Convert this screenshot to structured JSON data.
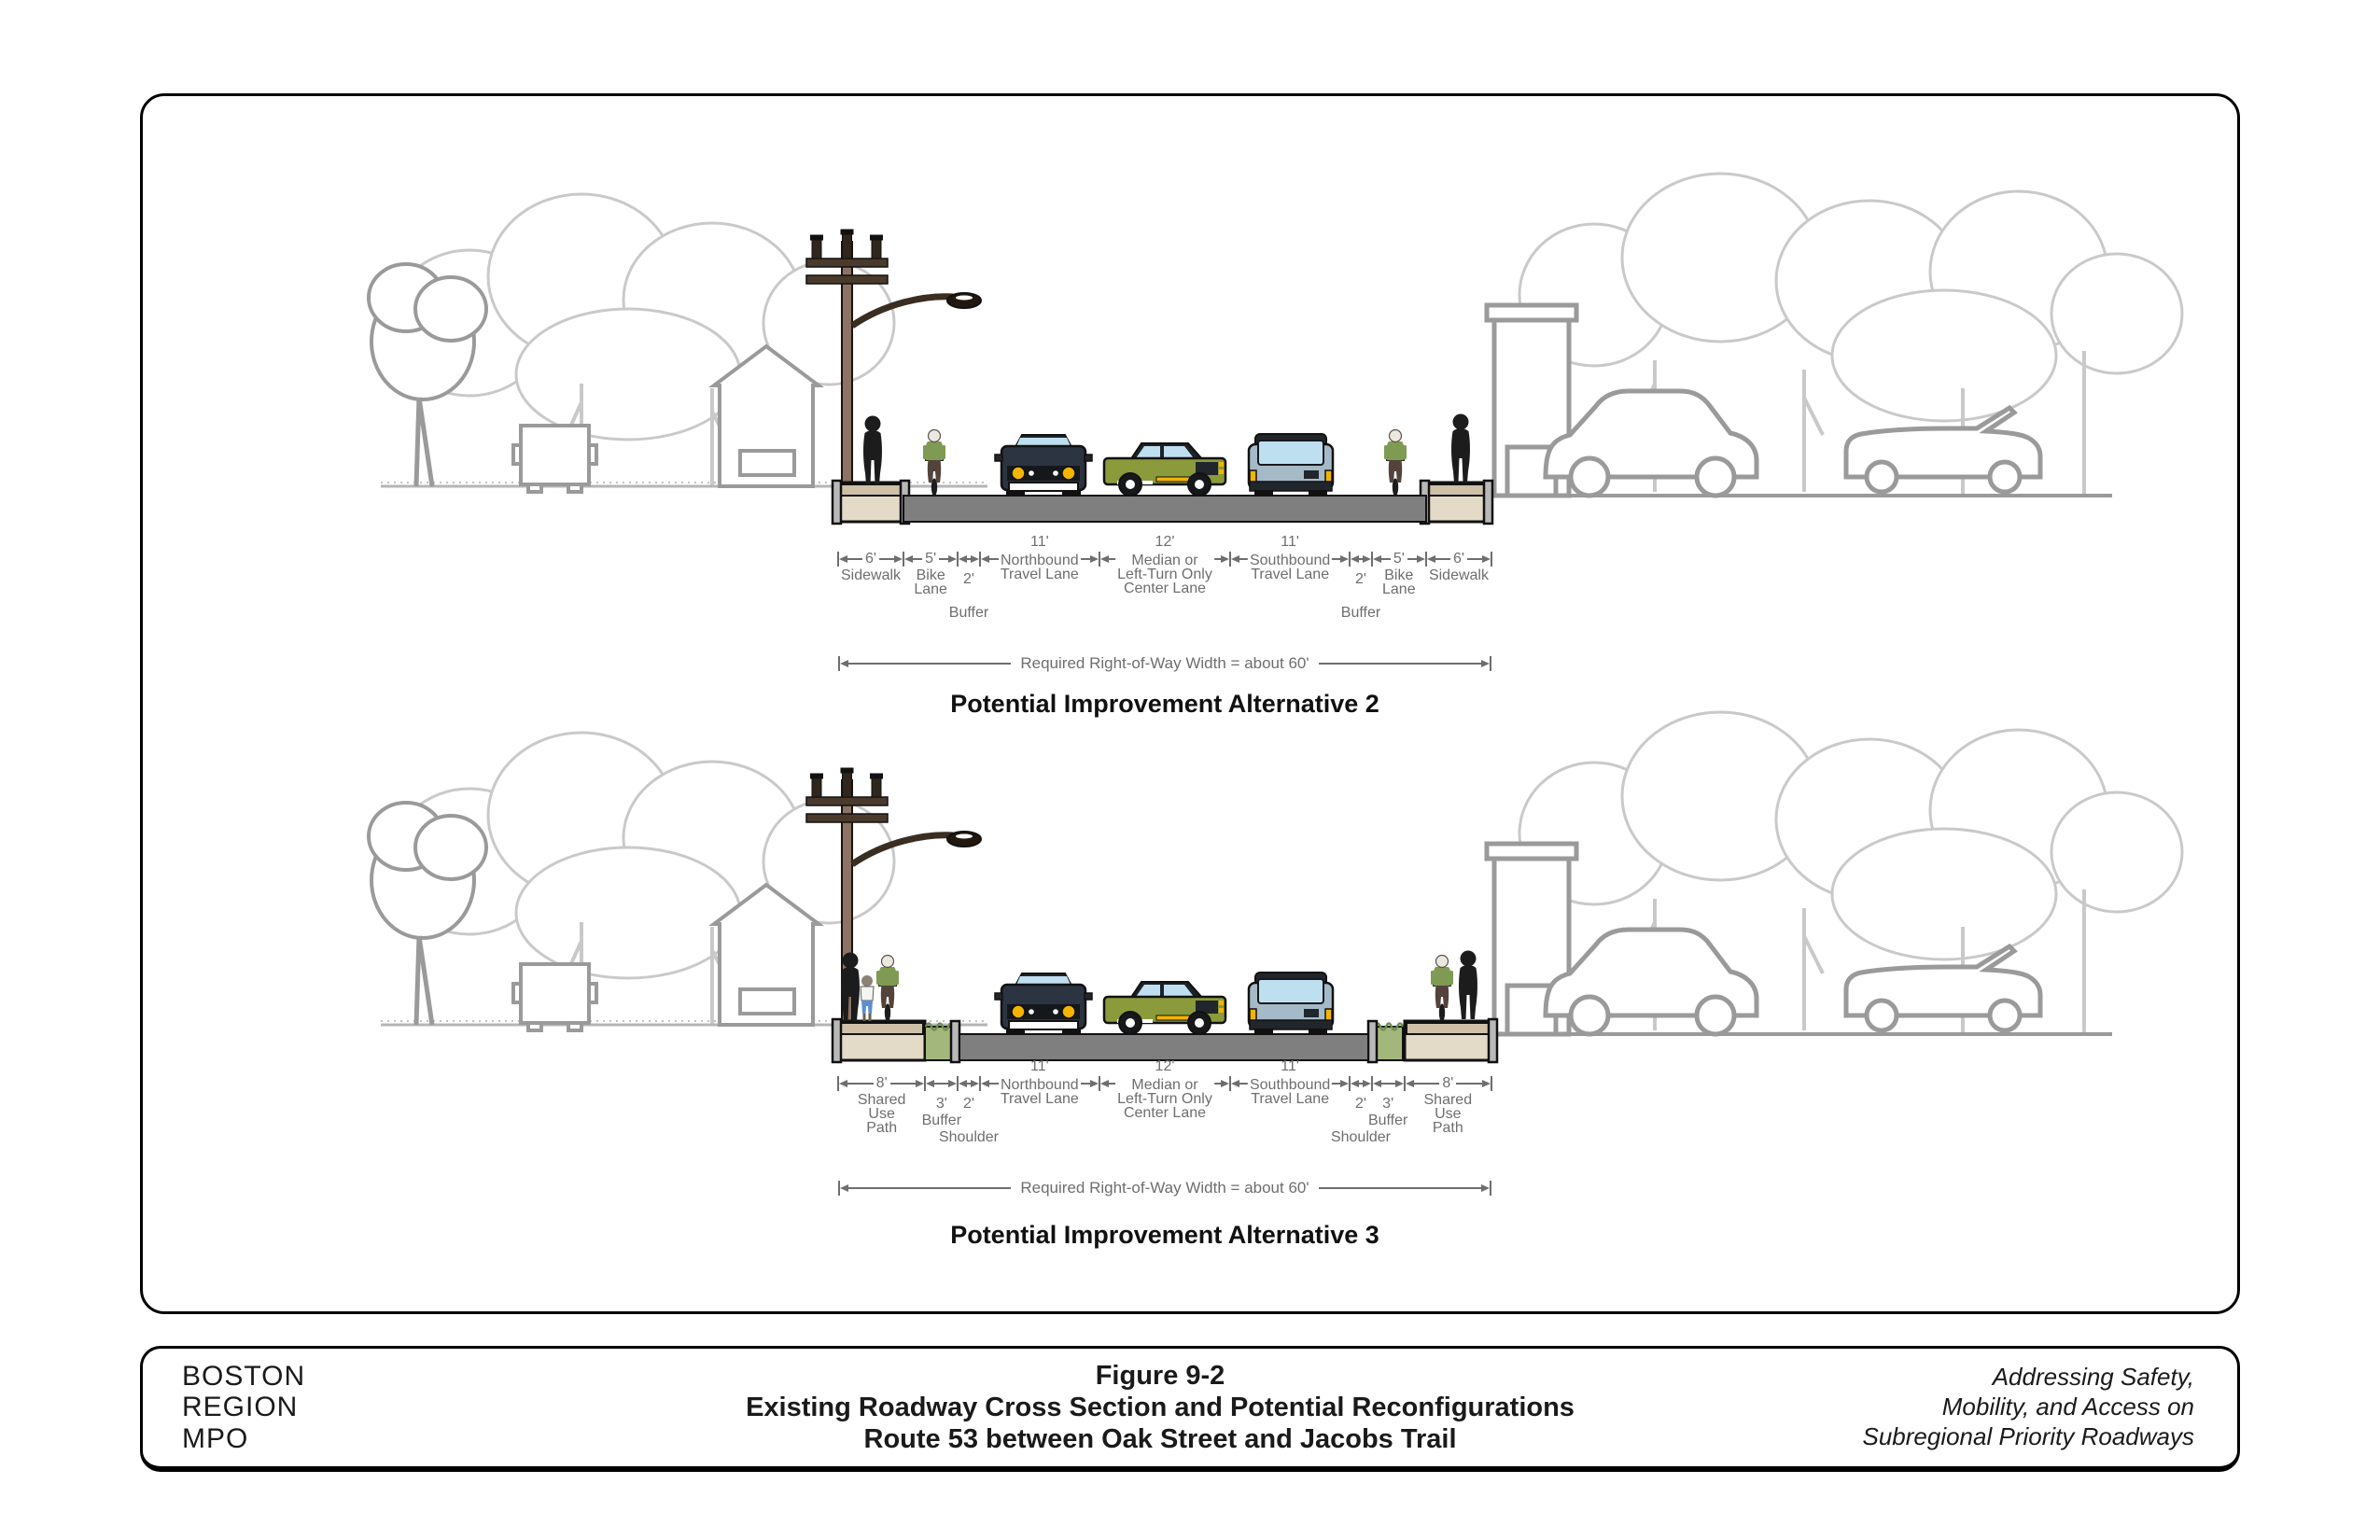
{
  "colors": {
    "road": "#7f7f7f",
    "sidewalk": "#cfc0a8",
    "sidewalk_light": "#e4dac8",
    "curb": "#b9b9b9",
    "grass_buffer": "#a3b77d",
    "grass_dark": "#6e8f50",
    "pole": "#8c7365",
    "tree_light": "#c9c9c9",
    "tree_dark": "#9a9a9a",
    "silhouette": "#1c1c1c",
    "shirt": "#7f9a52",
    "car_front_body": "#2b3440",
    "car_green": "#8b9a3b",
    "car_rear": "#a5bac8",
    "window": "#bedff0",
    "headlight": "#f4b400",
    "dim_text": "#6e6e6e"
  },
  "alt2": {
    "caption": "Potential Improvement Alternative 2",
    "row_label": "Required Right-of-Way Width = about 60'",
    "segments": [
      {
        "width_label": "6'",
        "name": "Sidewalk",
        "feet": 6
      },
      {
        "width_label": "5'",
        "name": "Bike\nLane",
        "feet": 5
      },
      {
        "width_label": "2'",
        "name": "Buffer",
        "feet": 2
      },
      {
        "width_label": "11'",
        "name": "Northbound\nTravel Lane",
        "feet": 11
      },
      {
        "width_label": "12'",
        "name": "Median or\nLeft-Turn Only\nCenter Lane",
        "feet": 12
      },
      {
        "width_label": "11'",
        "name": "Southbound\nTravel Lane",
        "feet": 11
      },
      {
        "width_label": "2'",
        "name": "Buffer",
        "feet": 2
      },
      {
        "width_label": "5'",
        "name": "Bike\nLane",
        "feet": 5
      },
      {
        "width_label": "6'",
        "name": "Sidewalk",
        "feet": 6
      }
    ]
  },
  "alt3": {
    "caption": "Potential Improvement Alternative 3",
    "row_label": "Required Right-of-Way Width = about 60'",
    "segments": [
      {
        "width_label": "8'",
        "name": "Shared\nUse\nPath",
        "feet": 8
      },
      {
        "width_label": "3'",
        "name": "Buffer",
        "feet": 3
      },
      {
        "width_label": "2'",
        "name": "Shoulder",
        "feet": 2
      },
      {
        "width_label": "11'",
        "name": "Northbound\nTravel Lane",
        "feet": 11
      },
      {
        "width_label": "12'",
        "name": "Median or\nLeft-Turn Only\nCenter Lane",
        "feet": 12
      },
      {
        "width_label": "11'",
        "name": "Southbound\nTravel Lane",
        "feet": 11
      },
      {
        "width_label": "2'",
        "name": "Shoulder",
        "feet": 2
      },
      {
        "width_label": "3'",
        "name": "Buffer",
        "feet": 3
      },
      {
        "width_label": "8'",
        "name": "Shared\nUse\nPath",
        "feet": 8
      }
    ]
  },
  "footer": {
    "org_line1": "BOSTON",
    "org_line2": "REGION",
    "org_line3": "MPO",
    "title_line1": "Figure 9-2",
    "title_line2": "Existing Roadway Cross Section and Potential Reconfigurations",
    "title_line3": "Route 53 between Oak Street and Jacobs Trail",
    "tagline_line1": "Addressing Safety,",
    "tagline_line2": "Mobility, and Access on",
    "tagline_line3": "Subregional Priority Roadways"
  }
}
